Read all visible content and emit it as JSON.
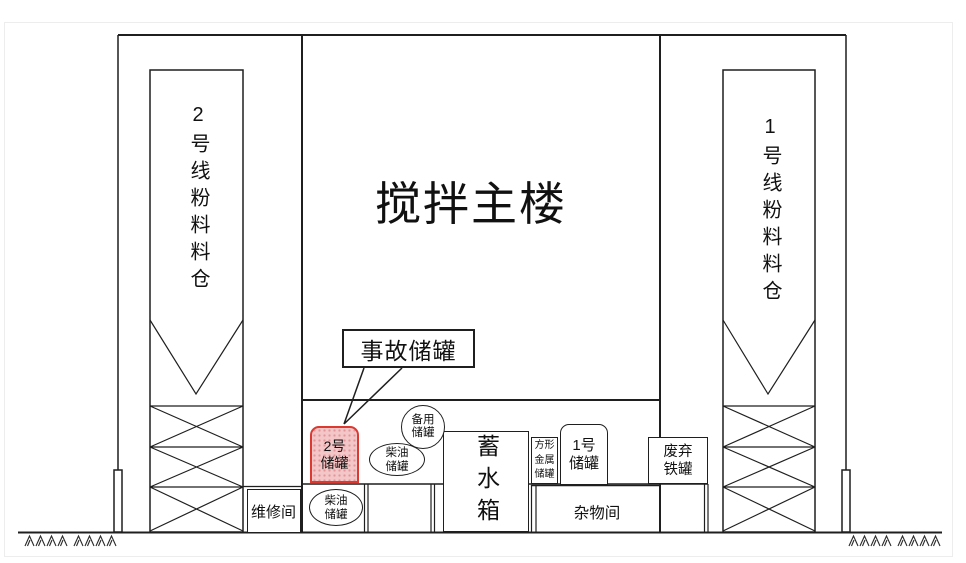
{
  "diagram_title": "搅拌站立面示意图",
  "main_building": {
    "label": "搅拌主楼"
  },
  "left_silo": {
    "label": "2号线粉料料仓"
  },
  "right_silo": {
    "label": "1号线粉料料仓"
  },
  "callout": {
    "label": "事故储罐"
  },
  "tanks": {
    "accident_tank": {
      "line1": "2号",
      "line2": "储罐"
    },
    "backup_tank": {
      "line1": "备用",
      "line2": "储罐"
    },
    "diesel_tank_upper": {
      "line1": "柴油",
      "line2": "储罐"
    },
    "diesel_tank_lower": {
      "line1": "柴油",
      "line2": "储罐"
    },
    "water_tank": {
      "label": "蓄水箱"
    },
    "square_metal_tank": {
      "line1": "方形",
      "line2": "金属",
      "line3": "储罐"
    },
    "tank_no1": {
      "line1": "1号",
      "line2": "储罐"
    },
    "scrap_iron_tank": {
      "line1": "废弃",
      "line2": "铁罐"
    }
  },
  "rooms": {
    "repair_room": {
      "label": "维修间"
    },
    "sundry_room": {
      "label": "杂物间"
    }
  },
  "colors": {
    "line": "#1f1f1f",
    "accident_fill": "#f3c6c7",
    "accident_border": "#dc3a31"
  }
}
